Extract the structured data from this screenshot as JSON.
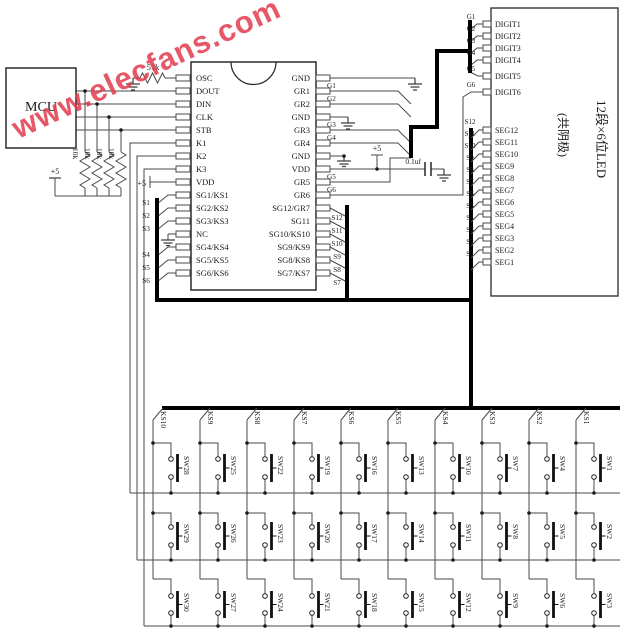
{
  "watermark": {
    "text": "www.elecfans.com",
    "color": "#e23b4e"
  },
  "mcu": {
    "label": "MCU"
  },
  "parts": {
    "osc_resistor": "51k",
    "pullup_resistor": "10k",
    "bypass_cap": "0.1uf",
    "vcc": "+5"
  },
  "chip": {
    "left_pins": [
      "OSC",
      "DOUT",
      "DIN",
      "CLK",
      "STB",
      "K1",
      "K2",
      "K3",
      "VDD",
      "SG1/KS1",
      "SG2/KS2",
      "SG3/KS3",
      "NC",
      "SG4/KS4",
      "SG5/KS5",
      "SG6/KS6"
    ],
    "right_pins": [
      "GND",
      "GR1",
      "GR2",
      "GND",
      "GR3",
      "GR4",
      "GND",
      "VDD",
      "GR5",
      "GR6",
      "SG12/GR7",
      "SG11",
      "SG10/KS10",
      "SG9/KS9",
      "SG8/KS8",
      "SG7/KS7"
    ],
    "left_nets": [
      "S1",
      "S2",
      "S3",
      "S4",
      "S5",
      "S6"
    ],
    "right_nets": [
      "S12",
      "S11",
      "S10",
      "S9",
      "S8",
      "S7"
    ],
    "digit_nets": [
      "G1",
      "G2",
      "G3",
      "G4",
      "G5",
      "G6"
    ]
  },
  "display": {
    "title": "12段×6位LED",
    "subtitle": "(共阴极)",
    "digit_pins": [
      "DIGIT1",
      "DIGIT2",
      "DIGIT3",
      "DIGIT4",
      "DIGIT5",
      "DIGIT6"
    ],
    "digit_nets": [
      "G1",
      "G2",
      "G3",
      "G4",
      "G5",
      "G6"
    ],
    "seg_pins": [
      "SEG12",
      "SEG11",
      "SEG10",
      "SEG9",
      "SEG8",
      "SEG7",
      "SEG6",
      "SEG5",
      "SEG4",
      "SEG3",
      "SEG2",
      "SEG1"
    ],
    "seg_nets": [
      "S12",
      "S11",
      "S10",
      "S9",
      "S8",
      "S7",
      "S6",
      "S5",
      "S4",
      "S3",
      "S2",
      "S1"
    ]
  },
  "matrix": {
    "columns": [
      {
        "ks": "KS10",
        "switches": [
          "SW28",
          "SW29",
          "SW30"
        ]
      },
      {
        "ks": "KS9",
        "switches": [
          "SW25",
          "SW26",
          "SW27"
        ]
      },
      {
        "ks": "KS8",
        "switches": [
          "SW22",
          "SW23",
          "SW24"
        ]
      },
      {
        "ks": "KS7",
        "switches": [
          "SW19",
          "SW20",
          "SW21"
        ]
      },
      {
        "ks": "KS6",
        "switches": [
          "SW16",
          "SW17",
          "SW18"
        ]
      },
      {
        "ks": "KS5",
        "switches": [
          "SW13",
          "SW14",
          "SW15"
        ]
      },
      {
        "ks": "KS4",
        "switches": [
          "SW10",
          "SW11",
          "SW12"
        ]
      },
      {
        "ks": "KS3",
        "switches": [
          "SW7",
          "SW8",
          "SW9"
        ]
      },
      {
        "ks": "KS2",
        "switches": [
          "SW4",
          "SW5",
          "SW6"
        ]
      },
      {
        "ks": "KS1",
        "switches": [
          "SW1",
          "SW2",
          "SW3"
        ]
      }
    ]
  }
}
